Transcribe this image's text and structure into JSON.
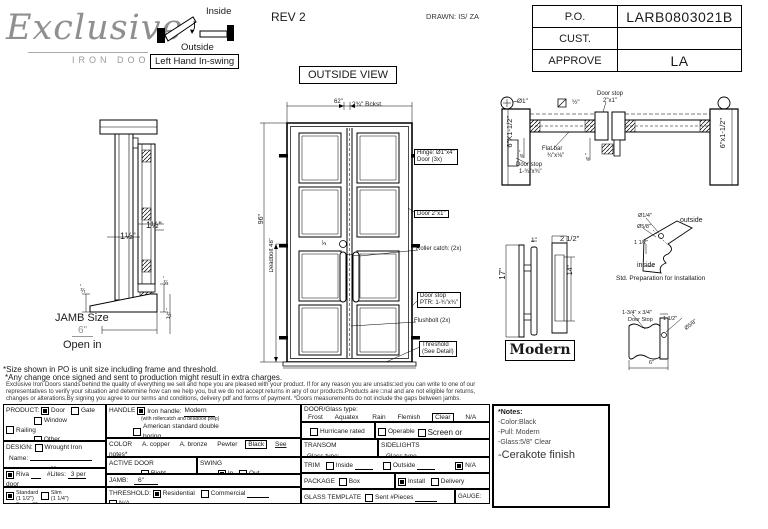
{
  "header": {
    "logo_script": "Exclusive",
    "logo_sub": "IRON DOORS",
    "swing": {
      "inside": "Inside",
      "outside": "Outside",
      "label": "Left Hand In-swing"
    },
    "rev": "REV 2",
    "drawn": "DRAWN: IS/ ZA",
    "po": {
      "po_label": "P.O.",
      "po_value": "LARB0803021B",
      "cust_label": "CUST.",
      "cust_value": "",
      "approve_label": "APPROVE",
      "approve_value": "LA"
    }
  },
  "view_label": "OUTSIDE VIEW",
  "jamb_profile": {
    "dim_top": "1½\"",
    "dim_mid": "1½\"",
    "dim_side": "½\"",
    "dim_sill_a": "½\"",
    "dim_sill_b": "1½\"",
    "size_label": "JAMB Size",
    "size_value": "6\"",
    "open": "Open in"
  },
  "elevation": {
    "width": "62\"",
    "backset": "2¾\" Bckst.",
    "height": "96\"",
    "deadbolt": "Deadbolt 48\"",
    "dim3": "3\"",
    "hinge1": "Hinge: Ø1\"x4\"",
    "hinge2": "Door (3x)",
    "door": "Door 2\"x1\"",
    "roller": "Roller catch: (2x)",
    "stop1": "Door stop",
    "stop2": "PTR: 1-¾\"x¾\"",
    "flushbolt": "Flushbolt (2x)",
    "thresh1": "Threshold",
    "thresh2": "(See Detail)"
  },
  "plan": {
    "dia1": "Ø1\"",
    "sq": "½\"",
    "stop_top1": "Door stop",
    "stop_top2": "2\"x1\"",
    "flat1": "Flat bar",
    "flat2": "¾\"x⅛\"",
    "jamb_l": "6\"X1-1/2\"",
    "jamb_r": "6\"x1-1/2\"",
    "te_a": "⅜\"",
    "te_b": "⅜\"",
    "stop_bot1": "Door stop",
    "stop_bot2": "1-¾\"x¾\""
  },
  "handle": {
    "d17": "17\"",
    "d1": "1\"",
    "d25": "2 1/2\"",
    "d14": "14\"",
    "style": "Modern"
  },
  "prep": {
    "dia14": "Ø1/4\"",
    "outside": "outside",
    "dia58": "Ø5/8\"",
    "d112": "1 1/2\"",
    "inside": "inside",
    "caption": "Std. Preparation for Installation"
  },
  "stopdet": {
    "l1": "1-3/4\" x 3/4\"",
    "l2": "Door Stop",
    "d112": "1 1/2\"",
    "dia58": "Ø5/8\"",
    "d6": "6\""
  },
  "disclaimer": {
    "line1": "*Size shown in PO is unit size including frame and threshold.",
    "line2": "*Any change once signed and sent to production might result in extra charges.",
    "body": "Exclusive Iron Doors stands behind the quality of everything we sell and hope you are pleased with your product. If for any reason you are unsatis□ed you can write to one of our representatives to verify your situation and determine how can we help you, but we do not accept returns in any of our products.Products are □nal and are not eligible for returns, changes or alterations.By signing you agree to our terms and conditions, delivery pdf and forms of payment. *Doors measurements do not include the gaps between jambs."
  },
  "form": {
    "product": {
      "label": "PRODUCT:",
      "door": {
        "label": "Door",
        "checked": true
      },
      "gate": {
        "label": "Gate",
        "checked": false
      },
      "window": {
        "label": "Window",
        "checked": false
      },
      "railing": {
        "label": "Railing",
        "checked": false
      },
      "other": {
        "label": "Other",
        "checked": false
      }
    },
    "design": {
      "label": "DESIGN:",
      "wrought": {
        "label": "Wrought Iron",
        "checked": false
      },
      "name_label": "Name:",
      "or_label": "or"
    },
    "riva": {
      "item": {
        "label": "Riva",
        "checked": true
      },
      "lites_label": "#Lites:",
      "lites_value": "3 per door"
    },
    "frame": {
      "standard": {
        "label": "Standard",
        "sub": "(1 1/2\")",
        "checked": true
      },
      "slim": {
        "label": "Slim",
        "sub": "(1 1/4\")",
        "checked": false
      },
      "superslim": {
        "label": "Super Slim",
        "sub": "(1/2\") SDL",
        "checked": false
      }
    },
    "handle": {
      "label": "HANDLE",
      "iron": {
        "label": "Iron handle:",
        "value": "Modern",
        "checked": true
      },
      "iron_sub": "(with rollercatch and deadbolt prep)",
      "american": {
        "label": "American standard double boring",
        "checked": false
      },
      "other": {
        "label": "Other:",
        "checked": false
      },
      "panic": {
        "label": "Panic hardware",
        "checked": false
      },
      "autocloser": {
        "label": "Autocloser #",
        "checked": false
      },
      "pbar": {
        "label": "P. Bar #",
        "checked": false
      }
    },
    "color": {
      "label": "COLOR",
      "opt1": "A. copper",
      "opt2": "A. bronze",
      "opt3": "Pewter",
      "selected": "Black",
      "see_notes": "See notes*"
    },
    "active_door": {
      "label": "ACTIVE DOOR",
      "right": {
        "label": "Right",
        "checked": false
      },
      "left": {
        "label": "Left",
        "checked": true
      }
    },
    "swing": {
      "label": "SWING",
      "in": {
        "label": "In",
        "checked": true
      },
      "out": {
        "label": "Out",
        "checked": false
      }
    },
    "jamb": {
      "label": "JAMB:",
      "value": "6\""
    },
    "threshold": {
      "label": "THRESHOLD:",
      "residential": {
        "label": "Residential",
        "checked": true
      },
      "commercial": {
        "label": "Commercial",
        "checked": false
      },
      "na": {
        "label": "N/A",
        "checked": false
      }
    },
    "glass": {
      "label": "DOOR/Glass type:",
      "opt1": "Frost",
      "opt2": "Aquatex",
      "opt3": "Rain",
      "opt4": "Flemish",
      "selected": "Clear",
      "opt5": "N/A"
    },
    "hurricane": {
      "label": "Hurricane rated",
      "checked": false
    },
    "operable": {
      "operable": {
        "label": "Operable",
        "checked": false
      },
      "screen": {
        "label": "Screen or",
        "checked": false
      },
      "fixed": {
        "label": "Fixed",
        "checked": true
      }
    },
    "transom": {
      "label": "TRANSOM",
      "glass_label": "Glass type:"
    },
    "sidelights": {
      "label": "SIDELIGHTS",
      "glass_label": "Glass type",
      "screen": {
        "label": "Screen",
        "checked": false
      }
    },
    "trim": {
      "label": "TRIM",
      "inside": {
        "label": "Inside",
        "checked": false
      },
      "outside": {
        "label": "Outside",
        "checked": false
      },
      "na": {
        "label": "N/A",
        "checked": true
      }
    },
    "package": {
      "label": "PACKAGE",
      "box": {
        "label": "Box",
        "checked": false
      },
      "nobox": {
        "label": "No box",
        "checked": true
      },
      "install": {
        "label": "Install",
        "checked": true
      },
      "delivery": {
        "label": "Delivery",
        "checked": false
      },
      "ltl": {
        "label": "LTL",
        "checked": false
      }
    },
    "glass_template": {
      "label": "GLASS TEMPLATE",
      "sent": {
        "label": "Sent #Pieces",
        "checked": false
      },
      "na": {
        "label": "N/A",
        "checked": false
      },
      "gauge": "GAUGE: 14"
    }
  },
  "notes": {
    "title": "*Notes:",
    "l1": "-Color:Black",
    "l2": "-Pull: Modern",
    "l3": "-Glass:5/8\" Clear",
    "l4": "-Cerakote finish"
  }
}
